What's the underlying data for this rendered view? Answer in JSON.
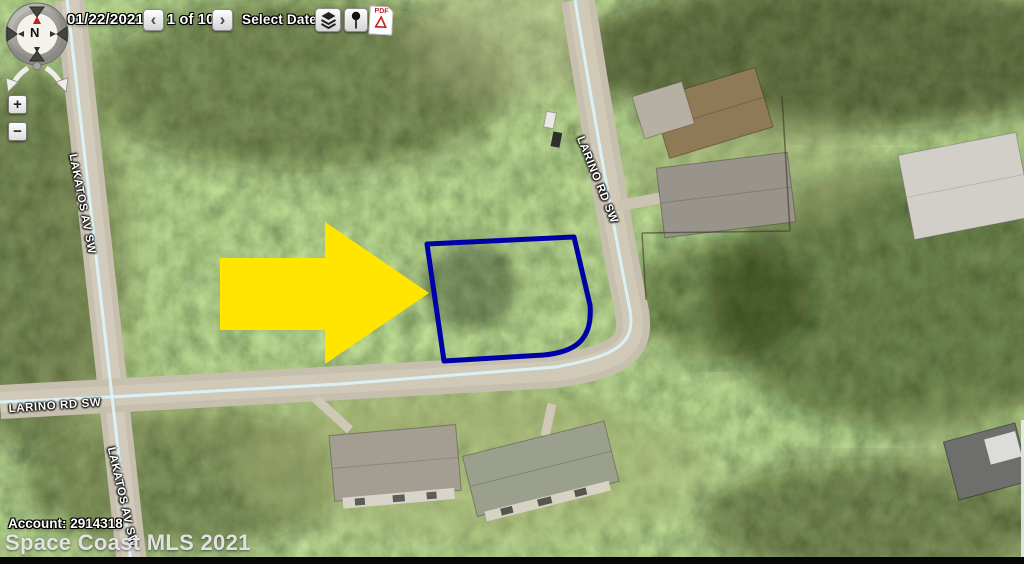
{
  "toolbar": {
    "date": "01/22/2021",
    "prev_label": "‹",
    "nav_position": "1 of 101",
    "next_label": "›",
    "select_date_label": "Select Date",
    "select_date_caret": "▾"
  },
  "compass": {
    "north_label": "N"
  },
  "zoom_controls": {
    "zoom_in_label": "+",
    "zoom_out_label": "−"
  },
  "map": {
    "road_labels": {
      "lakatos_upper": "LAKATOS AV SW",
      "larino_diagonal": "LARINO RD SW",
      "larino_horizontal": "LARINO RD SW",
      "lakatos_lower": "LAKATOS AV SW"
    }
  },
  "icons": {
    "pdf_label": "PDF"
  },
  "footer": {
    "account": "Account: 2914318",
    "watermark": "Space Coast MLS 2021"
  },
  "colors": {
    "parcel_outline": "#0000A8",
    "arrow_fill": "#FFE500",
    "road_centerline": "#D9F3F9"
  }
}
